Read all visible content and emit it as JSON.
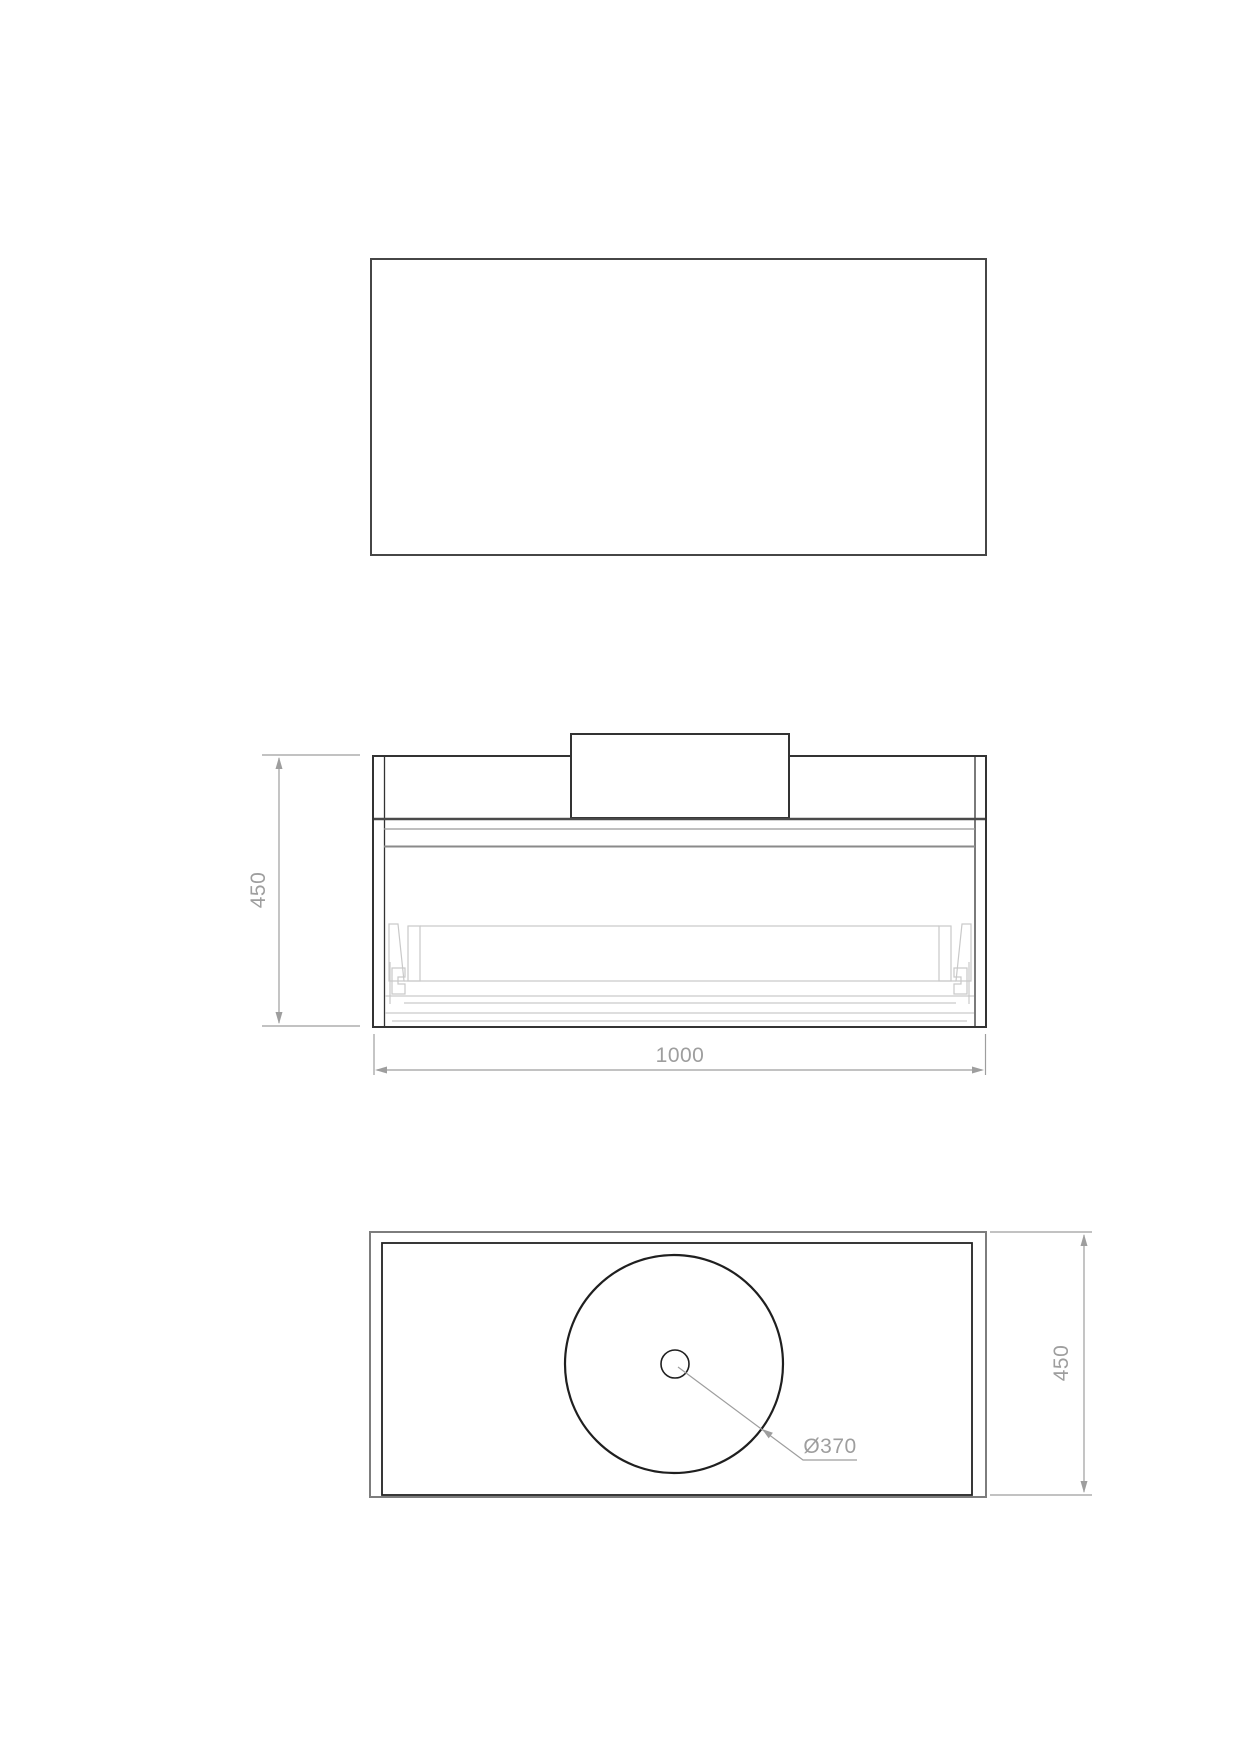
{
  "drawing": {
    "sheet": {
      "background": "#ffffff"
    },
    "views": {
      "top_panel": {
        "description": "plain rectangle, no annotations"
      },
      "front_elevation": {
        "dimensions": {
          "height": {
            "label": "450",
            "value_mm": 450,
            "side": "left",
            "orientation": "vertical"
          },
          "width": {
            "label": "1000",
            "value_mm": 1000,
            "side": "bottom",
            "orientation": "horizontal"
          }
        }
      },
      "plan": {
        "dimensions": {
          "depth": {
            "label": "450",
            "value_mm": 450,
            "side": "right",
            "orientation": "vertical"
          },
          "basin_diameter": {
            "label": "Ø370",
            "value_mm": 370,
            "annotation_type": "leader"
          }
        }
      }
    },
    "colors": {
      "outline_dark": "#333333",
      "outline_medium": "#7d7d7d",
      "secondary_line": "#8c8c8c",
      "hidden_detail": "#c9c9c9",
      "dimension": "#9e9e9e",
      "background": "#ffffff"
    }
  }
}
